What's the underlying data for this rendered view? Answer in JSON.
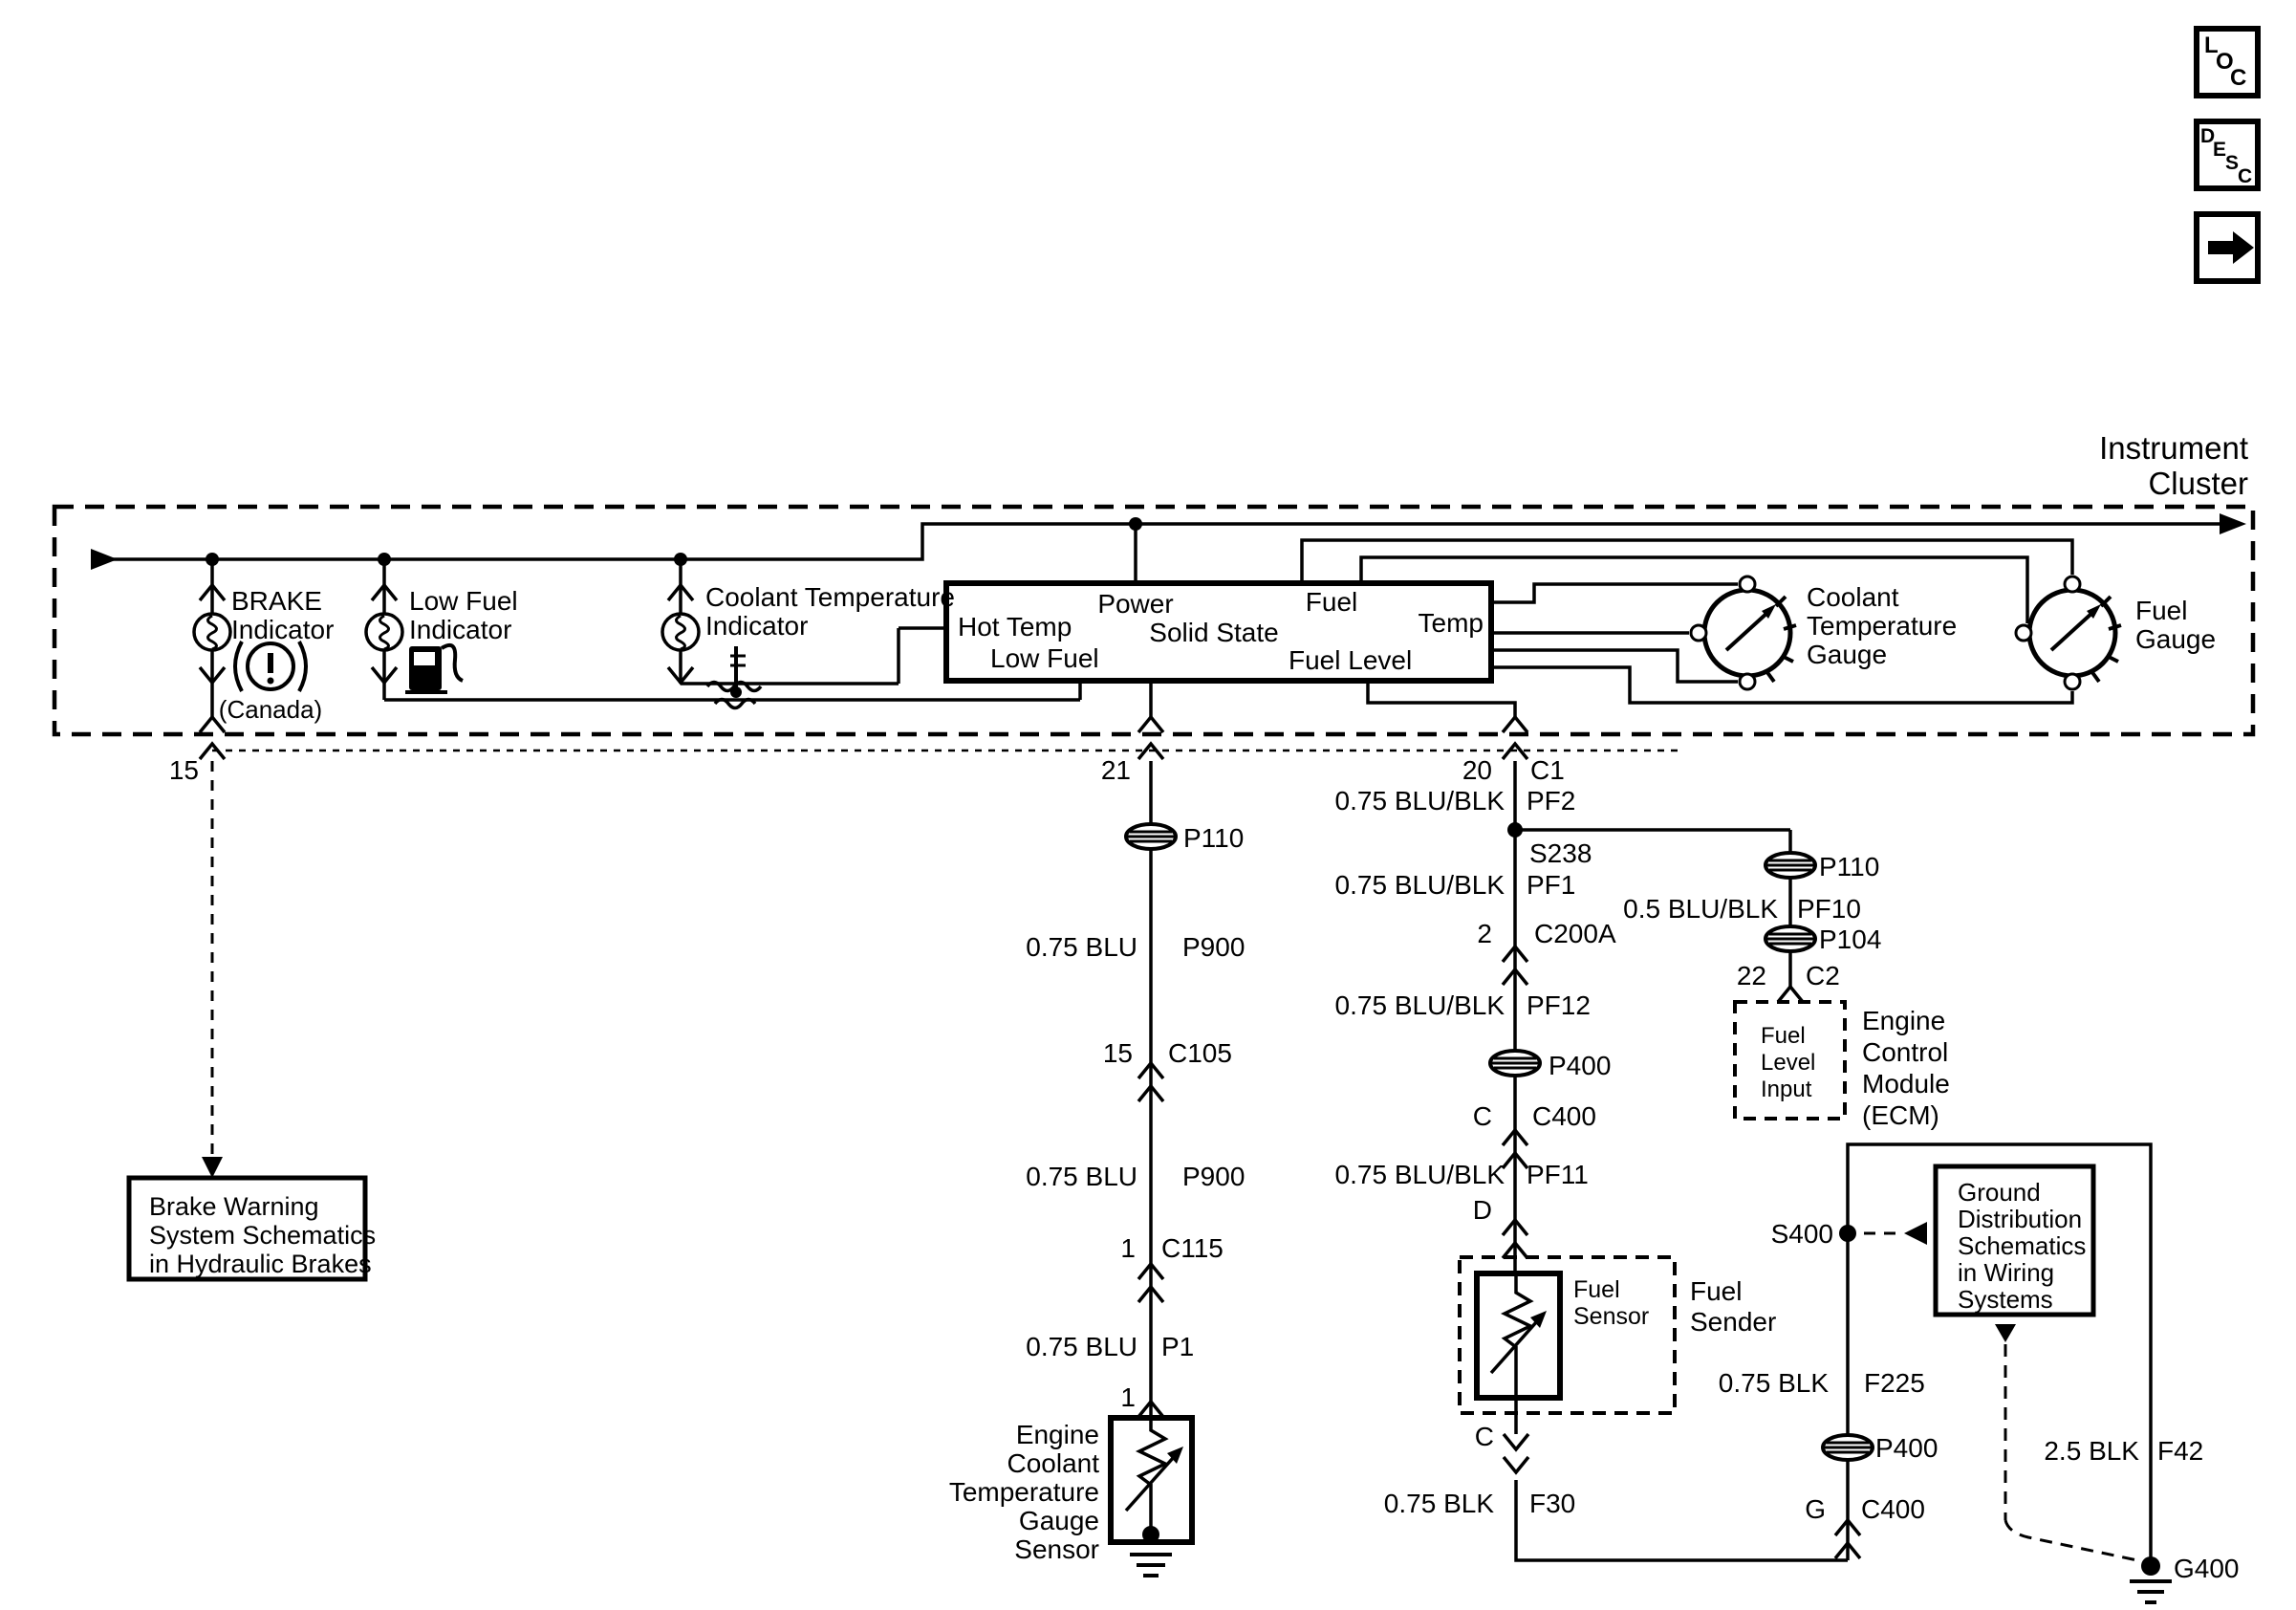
{
  "nav": {
    "loc": [
      "L",
      "O",
      "C"
    ],
    "desc": [
      "D",
      "E",
      "S",
      "C"
    ]
  },
  "cluster": {
    "title1": "Instrument",
    "title2": "Cluster",
    "pins": {
      "p15": "15",
      "p21": "21",
      "p20": "20",
      "c1": "C1"
    }
  },
  "indicators": {
    "brake": {
      "l1": "BRAKE",
      "l2": "Indicator",
      "canada": "(Canada)"
    },
    "low_fuel": {
      "l1": "Low Fuel",
      "l2": "Indicator"
    },
    "coolant": {
      "l1": "Coolant Temperature",
      "l2": "Indicator"
    }
  },
  "module": {
    "power": "Power",
    "fuel": "Fuel",
    "temp": "Temp",
    "hot_temp": "Hot Temp",
    "name": "Solid State",
    "low_fuel": "Low Fuel",
    "fuel_level": "Fuel Level"
  },
  "gauges": {
    "ct1": "Coolant",
    "ct2": "Temperature",
    "ct3": "Gauge",
    "fg1": "Fuel",
    "fg2": "Gauge"
  },
  "left_wire": {
    "g1": "P110",
    "w1": "0.75 BLU",
    "w1n": "P900",
    "c1pin": "15",
    "c1": "C105",
    "w2": "0.75 BLU",
    "w2n": "P900",
    "c2pin": "1",
    "c2": "C115",
    "w3": "0.75 BLU",
    "w3n": "P1",
    "pin": "1"
  },
  "ect": {
    "l1": "Engine",
    "l2": "Coolant",
    "l3": "Temperature",
    "l4": "Gauge",
    "l5": "Sensor"
  },
  "center_wire": {
    "w1": "0.75 BLU/BLK",
    "w1n": "PF2",
    "splice": "S238",
    "w2": "0.75 BLU/BLK",
    "w2n": "PF1",
    "c1pin": "2",
    "c1": "C200A",
    "w3": "0.75 BLU/BLK",
    "w3n": "PF12",
    "g1": "P400",
    "c2pin": "C",
    "c2": "C400",
    "w4": "0.75 BLU/BLK",
    "w4n": "PF11",
    "c3pin": "D",
    "sensor1": "Fuel",
    "sensor2": "Sensor",
    "sender1": "Fuel",
    "sender2": "Sender",
    "c4pin": "C",
    "w5": "0.75 BLK",
    "w5n": "F30"
  },
  "ecm_branch": {
    "g1": "P110",
    "w1": "0.5 BLU/BLK",
    "w1n": "PF10",
    "g2": "P104",
    "pin": "22",
    "conn": "C2",
    "input1": "Fuel",
    "input2": "Level",
    "input3": "Input",
    "name1": "Engine",
    "name2": "Control",
    "name3": "Module",
    "name4": "(ECM)"
  },
  "ground_path": {
    "splice": "S400",
    "w1": "0.75 BLK",
    "w1n": "F225",
    "g1": "P400",
    "c1pin": "G",
    "c1": "C400",
    "w2": "2.5 BLK",
    "w2n": "F42",
    "ground": "G400"
  },
  "ref_boxes": {
    "brake1": "Brake Warning",
    "brake2": "System Schematics",
    "brake3": "in Hydraulic Brakes",
    "gnd1": "Ground",
    "gnd2": "Distribution",
    "gnd3": "Schematics",
    "gnd4": "in Wiring",
    "gnd5": "Systems"
  }
}
